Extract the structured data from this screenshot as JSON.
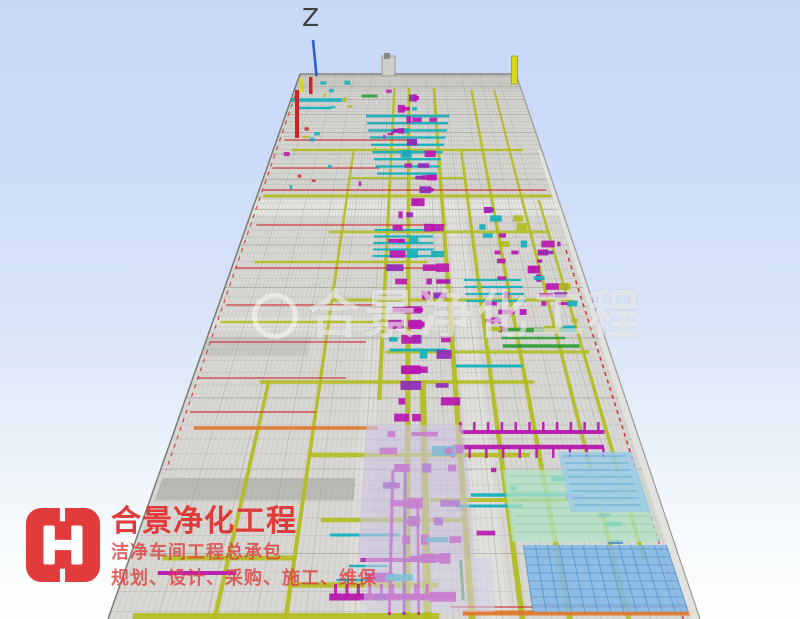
{
  "viewport": {
    "z_axis_label": "Z"
  },
  "watermark": {
    "text": "合景净化工程"
  },
  "branding": {
    "company_name": "合景净化工程",
    "tagline_1": "洁净车间工程总承包",
    "tagline_2": "规划、设计、采购、施工、维保"
  },
  "palette": {
    "background_top": "#c7d8f7",
    "background_bottom": "#fdfefe",
    "structure_gray": "#d8d7d3",
    "truss_line": "#a9aaa5",
    "truss_line_dark": "#8f908b",
    "beam_olive": "#b2bc1e",
    "beam_yellow": "#d8d81e",
    "duct_magenta": "#b818b0",
    "duct_purple": "#8f2ab8",
    "duct_cyan": "#15b0bc",
    "duct_green": "#2f9e38",
    "pipe_red": "#cc2424",
    "pipe_orange": "#e0782a",
    "panel_blue": "#84b9e8",
    "panel_blue_grid": "#4f8cc8",
    "panel_mint": "#b2e2c4",
    "panel_mint_grid": "#7ac898",
    "panel_lavender": "#cec5e2",
    "panel_lavender_grid": "#b8aed0",
    "axis_blue": "#2b5cd0",
    "logo_red": "#e23b3b",
    "watermark_white": "rgba(252,252,252,0.55)"
  }
}
